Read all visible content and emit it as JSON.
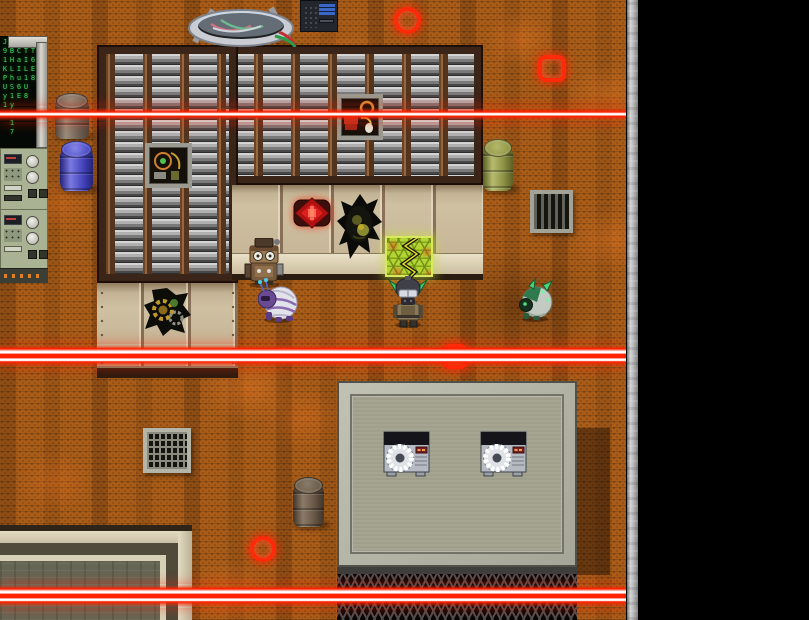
{
  "scene": {
    "game_title_hint": "top-down industrial facility map with laser security grid",
    "viewport": "game canvas left, black letterbox right"
  },
  "theme": {
    "laser_red": "#ff2000",
    "laser_core": "#ffffff",
    "alert_red": "#ff2a0a",
    "floor_orange": "#a85c18",
    "roof_brown": "#3b2418",
    "wall_tan": "#cfc0a2",
    "panel_green": "#a9b293",
    "matrix_green": "#3fd060",
    "hex_panel_green": "#b4d434",
    "platform_gray": "#a5a591",
    "strip_gray": "#b6b6b6"
  },
  "terminal": {
    "columns": [
      "J91KPUy1",
      "HBHLhS1yI17",
      "1CaIu6E",
      "9TIL1U8",
      "1T6E8"
    ]
  },
  "sprites": {
    "robot": "steampunk-maintenance-robot",
    "purple_bug": "purple-beetle-creature",
    "soldier": "gas-mask-soldier",
    "green_mech": "green-mech-beetle"
  },
  "security": {
    "laser_count": 3,
    "circle_markers": 2,
    "square_markers": 2
  }
}
